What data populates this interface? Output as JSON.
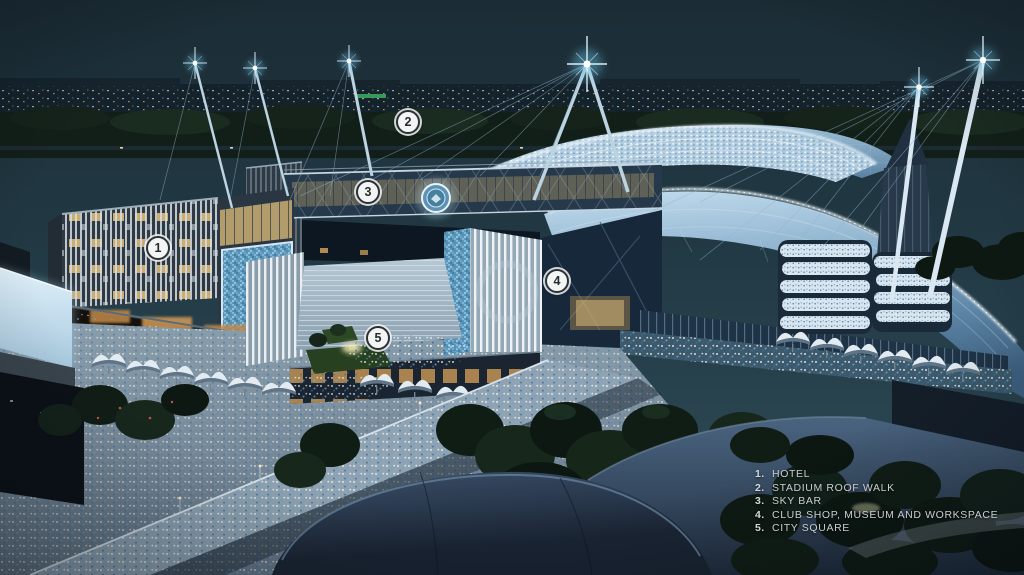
{
  "callouts": {
    "markers": [
      {
        "num": "1"
      },
      {
        "num": "2"
      },
      {
        "num": "3"
      },
      {
        "num": "4"
      },
      {
        "num": "5"
      }
    ]
  },
  "legend": {
    "items": [
      {
        "num": "1.",
        "label": "HOTEL"
      },
      {
        "num": "2.",
        "label": "STADIUM ROOF WALK"
      },
      {
        "num": "3.",
        "label": "SKY BAR"
      },
      {
        "num": "4.",
        "label": "CLUB SHOP, MUSEUM AND WORKSPACE"
      },
      {
        "num": "5.",
        "label": "CITY SQUARE"
      }
    ]
  },
  "icons": {
    "club_crest_badge": "glowing-circular-club-crest",
    "mast_light": "four-point-star-flare"
  },
  "colors": {
    "sky_top": "#1b2c35",
    "sky_horizon": "#2d4a57",
    "stadium_roof_glow": "#c2dcee",
    "mosaic_panel": "#6aa2c4",
    "mast_light": "#dff4ff",
    "crowd_blue": "#6fa3cc",
    "legend_text": "#c9ced2",
    "marker_bg": "#f3f5f5",
    "marker_ring": "#2b3034"
  }
}
